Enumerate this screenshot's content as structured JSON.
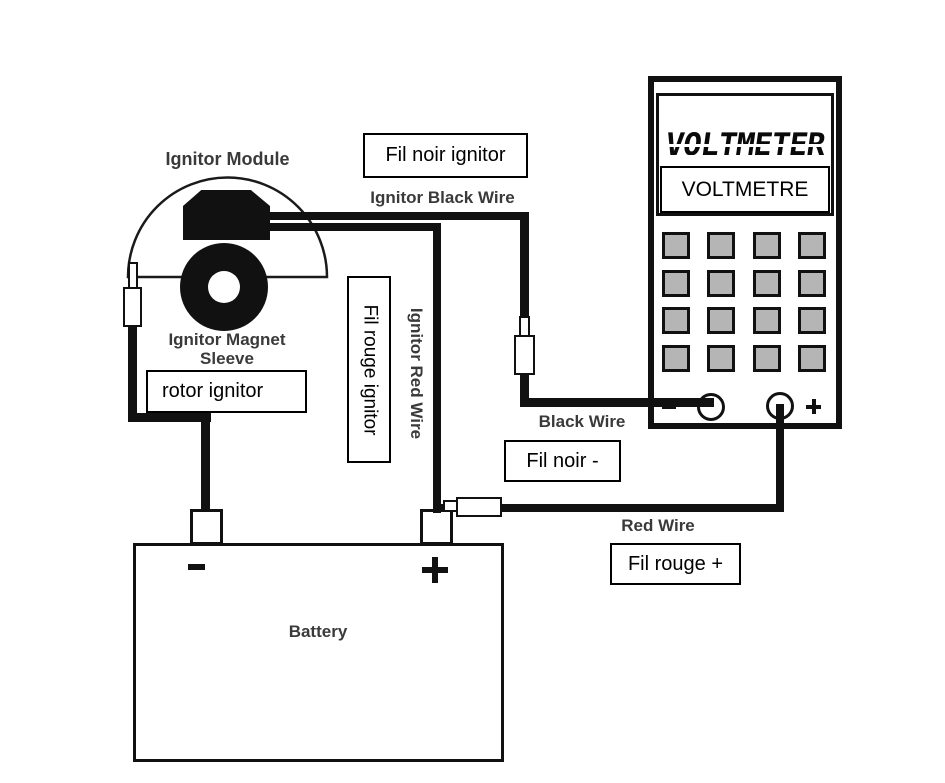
{
  "diagram": {
    "module": {
      "title": "Ignitor Module",
      "magnet_label_line1": "Ignitor Magnet",
      "magnet_label_line2": "Sleeve",
      "rotor_box_label": "rotor ignitor"
    },
    "wires": {
      "fil_noir_ignitor_box": "Fil noir ignitor",
      "ignitor_black_wire": "Ignitor Black Wire",
      "fil_rouge_ignitor_box": "Fil rouge ignitor",
      "ignitor_red_wire": "Ignitor Red Wire",
      "black_wire": "Black Wire",
      "fil_noir_box": "Fil noir -",
      "red_wire": "Red Wire",
      "fil_rouge_box": "Fil rouge +"
    },
    "voltmeter": {
      "display_text": "VOLTMETER",
      "overlay_label": "VOLTMETRE",
      "keypad": {
        "rows": 4,
        "cols": 4
      },
      "minus_sign": "-",
      "plus_sign": "+"
    },
    "battery": {
      "label": "Battery",
      "minus_sign": "-",
      "plus_sign": "+"
    },
    "colors": {
      "wire_black": "#111111",
      "keypad_button_gray": "#b5b5b5",
      "label_gray": "#3a3a3a"
    }
  }
}
